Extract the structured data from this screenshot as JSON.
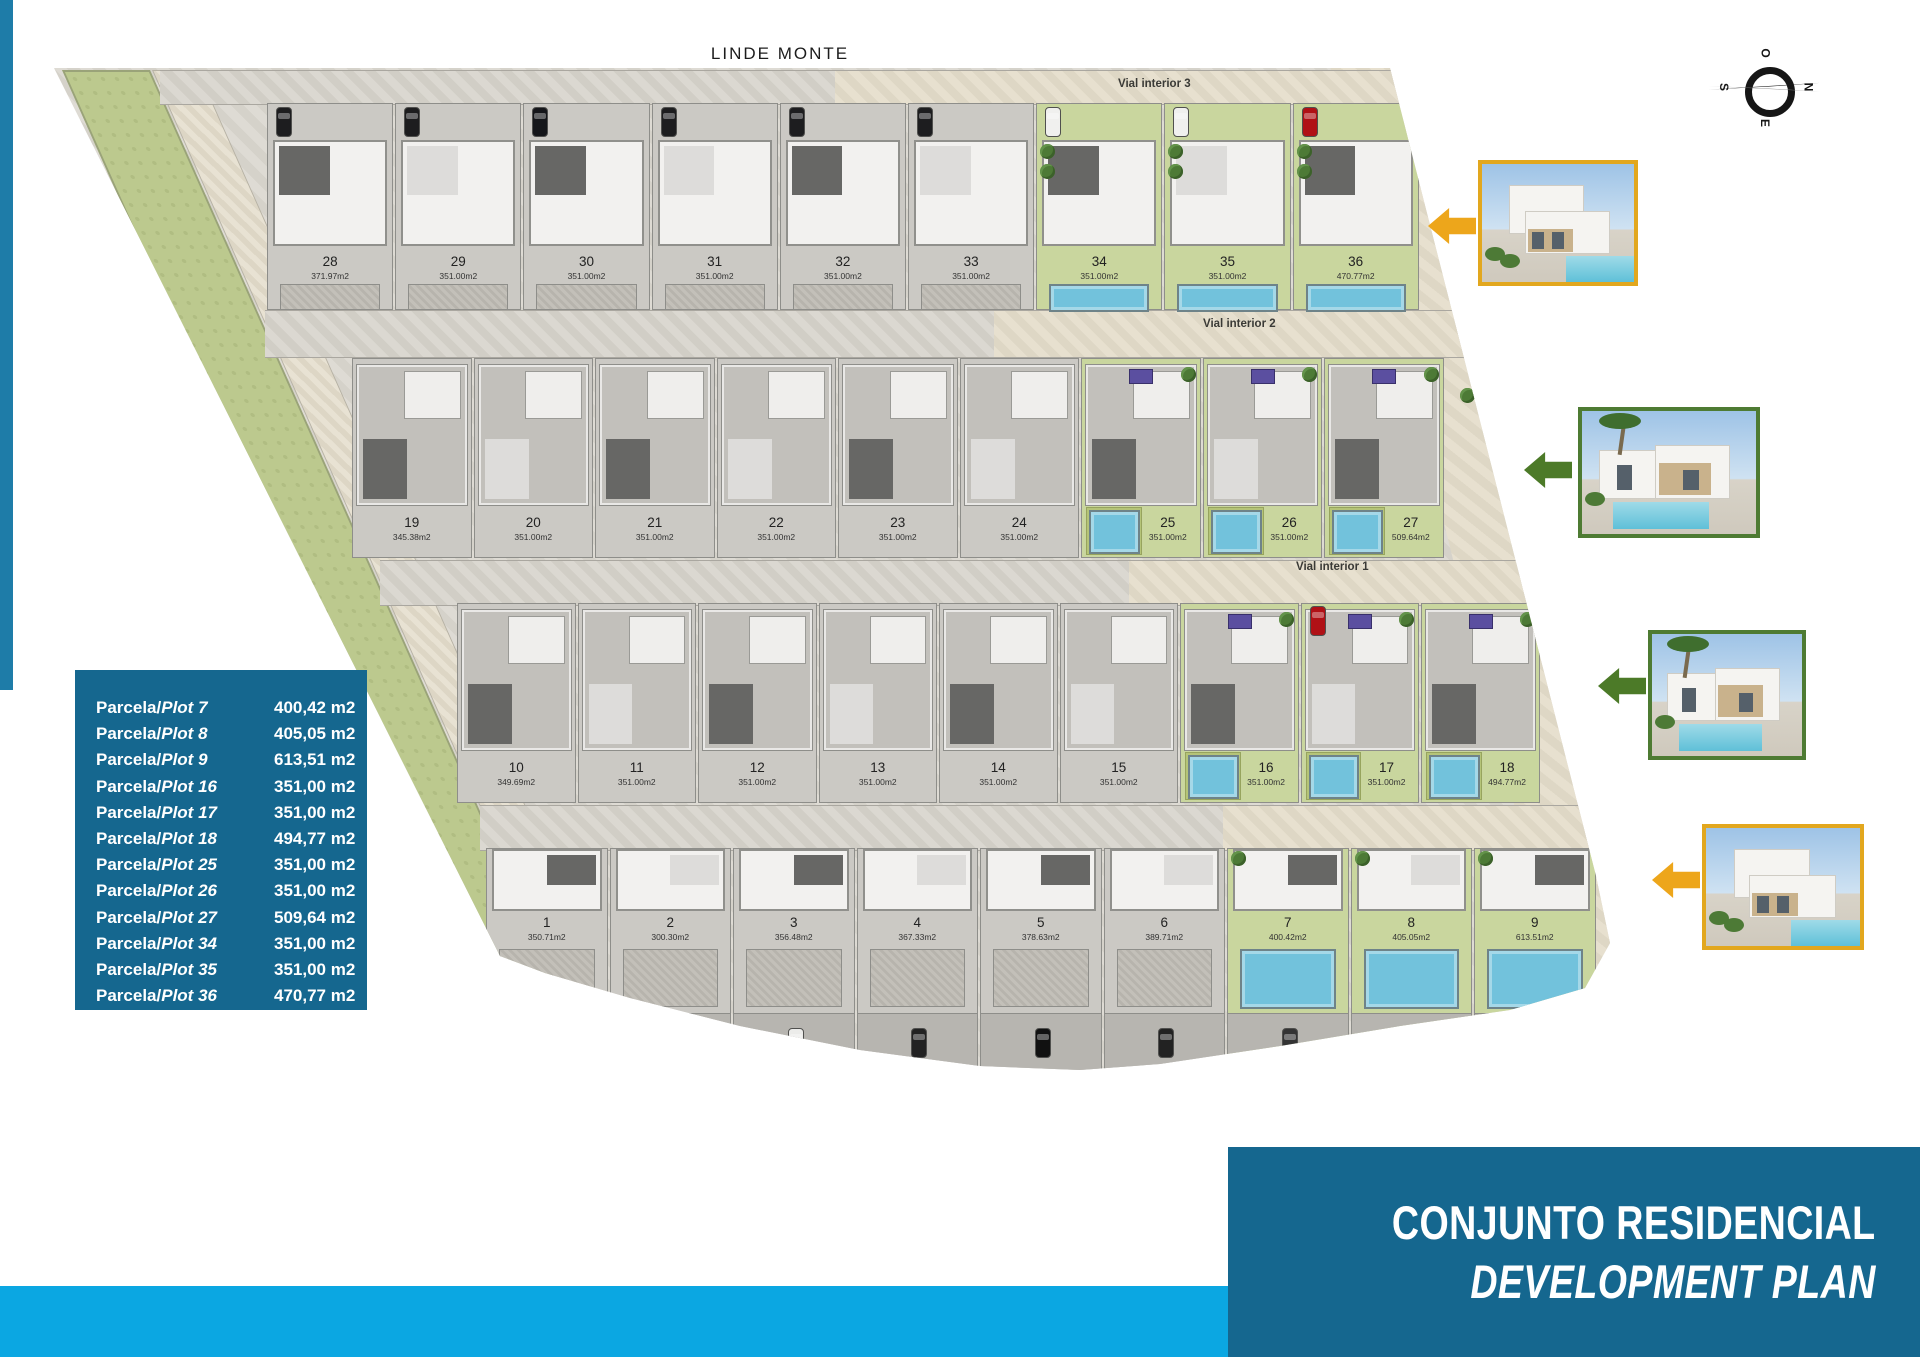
{
  "header": {
    "top_label": "LINDE MONTE"
  },
  "compass": {
    "top": "O",
    "right": "N",
    "bottom": "E",
    "left": "S"
  },
  "roads": [
    {
      "label": "Vial interior 3"
    },
    {
      "label": "Vial interior 2"
    },
    {
      "label": "Vial interior 1"
    }
  ],
  "plot_rows": [
    {
      "plots": [
        {
          "num": "28",
          "area": "371.97m2",
          "colored": false
        },
        {
          "num": "29",
          "area": "351.00m2",
          "colored": false
        },
        {
          "num": "30",
          "area": "351.00m2",
          "colored": false
        },
        {
          "num": "31",
          "area": "351.00m2",
          "colored": false
        },
        {
          "num": "32",
          "area": "351.00m2",
          "colored": false
        },
        {
          "num": "33",
          "area": "351.00m2",
          "colored": false
        },
        {
          "num": "34",
          "area": "351.00m2",
          "colored": true
        },
        {
          "num": "35",
          "area": "351.00m2",
          "colored": true
        },
        {
          "num": "36",
          "area": "470.77m2",
          "colored": true
        }
      ]
    },
    {
      "plots": [
        {
          "num": "19",
          "area": "345.38m2",
          "colored": false
        },
        {
          "num": "20",
          "area": "351.00m2",
          "colored": false
        },
        {
          "num": "21",
          "area": "351.00m2",
          "colored": false
        },
        {
          "num": "22",
          "area": "351.00m2",
          "colored": false
        },
        {
          "num": "23",
          "area": "351.00m2",
          "colored": false
        },
        {
          "num": "24",
          "area": "351.00m2",
          "colored": false
        },
        {
          "num": "25",
          "area": "351.00m2",
          "colored": true
        },
        {
          "num": "26",
          "area": "351.00m2",
          "colored": true
        },
        {
          "num": "27",
          "area": "509.64m2",
          "colored": true
        }
      ]
    },
    {
      "plots": [
        {
          "num": "10",
          "area": "349.69m2",
          "colored": false
        },
        {
          "num": "11",
          "area": "351.00m2",
          "colored": false
        },
        {
          "num": "12",
          "area": "351.00m2",
          "colored": false
        },
        {
          "num": "13",
          "area": "351.00m2",
          "colored": false
        },
        {
          "num": "14",
          "area": "351.00m2",
          "colored": false
        },
        {
          "num": "15",
          "area": "351.00m2",
          "colored": false
        },
        {
          "num": "16",
          "area": "351.00m2",
          "colored": true
        },
        {
          "num": "17",
          "area": "351.00m2",
          "colored": true
        },
        {
          "num": "18",
          "area": "494.77m2",
          "colored": true
        }
      ]
    },
    {
      "plots": [
        {
          "num": "1",
          "area": "350.71m2",
          "colored": false
        },
        {
          "num": "2",
          "area": "300.30m2",
          "colored": false
        },
        {
          "num": "3",
          "area": "356.48m2",
          "colored": false
        },
        {
          "num": "4",
          "area": "367.33m2",
          "colored": false
        },
        {
          "num": "5",
          "area": "378.63m2",
          "colored": false
        },
        {
          "num": "6",
          "area": "389.71m2",
          "colored": false
        },
        {
          "num": "7",
          "area": "400.42m2",
          "colored": true
        },
        {
          "num": "8",
          "area": "405.05m2",
          "colored": true
        },
        {
          "num": "9",
          "area": "613.51m2",
          "colored": true
        }
      ]
    }
  ],
  "legend": {
    "entries": [
      {
        "prefix": "Parcela/",
        "plot": "Plot 7",
        "area": "400,42 m2"
      },
      {
        "prefix": "Parcela/",
        "plot": "Plot 8",
        "area": "405,05 m2"
      },
      {
        "prefix": "Parcela/",
        "plot": "Plot 9",
        "area": "613,51 m2"
      },
      {
        "prefix": "Parcela/",
        "plot": "Plot 16",
        "area": "351,00 m2"
      },
      {
        "prefix": "Parcela/",
        "plot": "Plot 17",
        "area": "351,00 m2"
      },
      {
        "prefix": "Parcela/",
        "plot": "Plot 18",
        "area": "494,77 m2"
      },
      {
        "prefix": "Parcela/",
        "plot": "Plot 25",
        "area": "351,00 m2"
      },
      {
        "prefix": "Parcela/",
        "plot": "Plot 26",
        "area": "351,00 m2"
      },
      {
        "prefix": "Parcela/",
        "plot": "Plot 27",
        "area": "509,64 m2"
      },
      {
        "prefix": "Parcela/",
        "plot": "Plot 34",
        "area": "351,00 m2"
      },
      {
        "prefix": "Parcela/",
        "plot": "Plot 35",
        "area": "351,00 m2"
      },
      {
        "prefix": "Parcela/",
        "plot": "Plot 36",
        "area": "470,77 m2"
      }
    ]
  },
  "title_block": {
    "line1": "CONJUNTO RESIDENCIAL",
    "line2": "DEVELOPMENT PLAN"
  },
  "photos": [
    {
      "border": "#e2a71e",
      "arrow": "#eda61b",
      "variant": "two-storey"
    },
    {
      "border": "#4e7b33",
      "arrow": "#4c7a28",
      "variant": "palm"
    },
    {
      "border": "#4e7b33",
      "arrow": "#4c7a28",
      "variant": "palm"
    },
    {
      "border": "#e2a71e",
      "arrow": "#eda61b",
      "variant": "two-storey"
    }
  ],
  "colors": {
    "primary_blue": "#15678f",
    "cyan_bar": "#0ba7e2",
    "pool": "#72c2dc",
    "garden_green": "#c9d69e",
    "buffer_green": "#bcc98e",
    "orange_accent": "#eda61b",
    "green_accent": "#4c7a28"
  }
}
